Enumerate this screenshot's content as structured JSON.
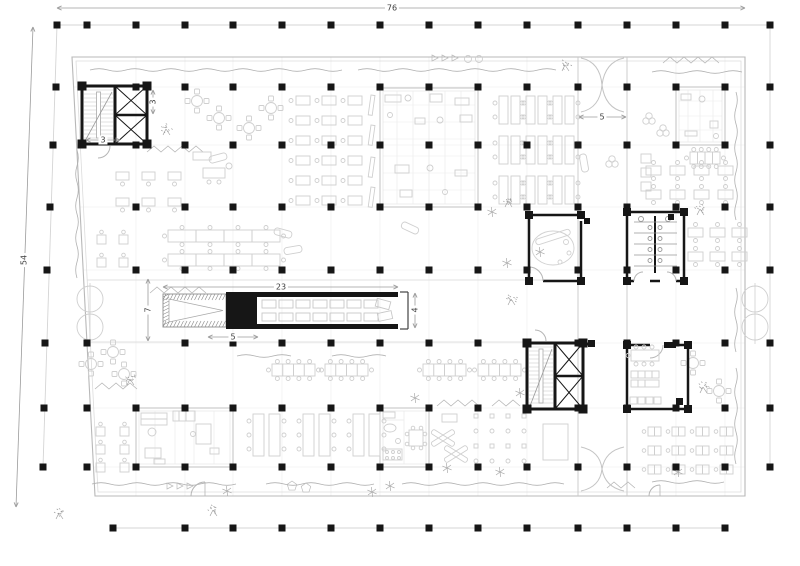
{
  "title": "office-building-floor-plan",
  "canvas": {
    "width": 800,
    "height": 566
  },
  "colors": {
    "background": "#ffffff",
    "structure_black": "#161616",
    "wall_gray": "#b8b8b8",
    "partition_gray": "#c2c2c2",
    "furniture_gray": "#cfcfcf",
    "grid_faint": "#ececec",
    "curtain_gray": "#b0b0b0",
    "dimension_line": "#9b9b9b",
    "dimension_text": "#3c3c3c"
  },
  "dimensions": {
    "overall_width": {
      "label": "76"
    },
    "overall_depth": {
      "label": "54"
    },
    "bridge_length": {
      "label": "23"
    },
    "bridge_bay_depth": {
      "label": "7"
    },
    "escalator_length": {
      "label": "5"
    },
    "bridge_width": {
      "label": "4"
    },
    "atrium_gap_width": {
      "label": "5"
    },
    "stair_width": {
      "label": "3"
    },
    "elevator_shaft_width": {
      "label": "3"
    }
  },
  "legend": {
    "structures": [
      "column-grid",
      "stair-core-northwest",
      "stair-core-south",
      "elevator-shafts",
      "restroom-block",
      "meeting-room",
      "breakout-room",
      "bridge-walkway",
      "escalator",
      "north-entrance",
      "south-entrance",
      "open-plan-desks",
      "classroom-tables",
      "landscaping-trees"
    ]
  }
}
